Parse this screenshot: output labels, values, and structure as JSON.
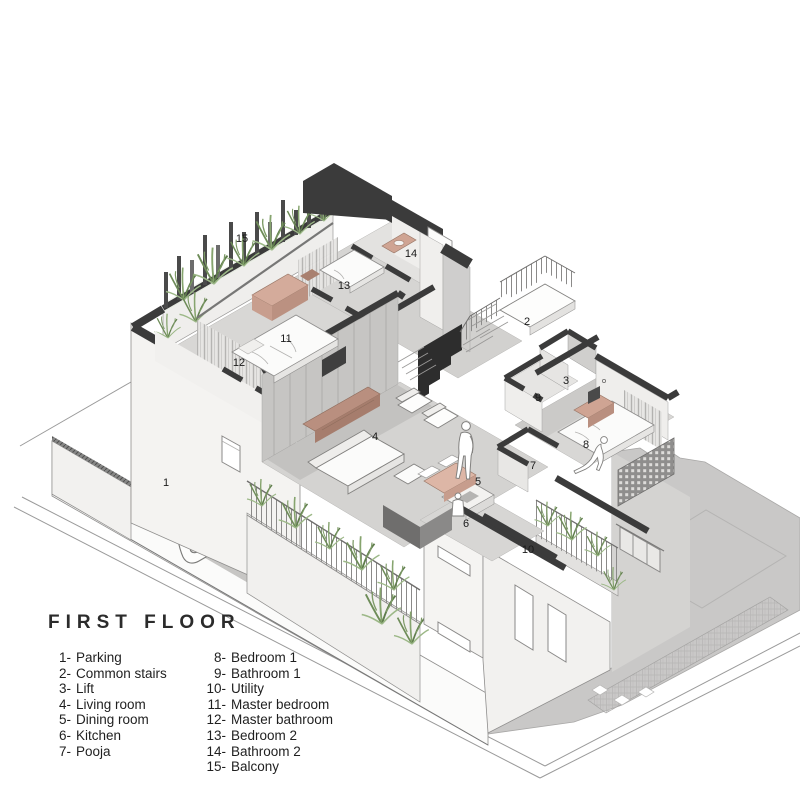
{
  "title": "FIRST FLOOR",
  "legend": {
    "column1": [
      {
        "num": "1-",
        "label": "Parking"
      },
      {
        "num": "2-",
        "label": "Common stairs"
      },
      {
        "num": "3-",
        "label": "Lift"
      },
      {
        "num": "4-",
        "label": "Living room"
      },
      {
        "num": "5-",
        "label": "Dining room"
      },
      {
        "num": "6-",
        "label": "Kitchen"
      },
      {
        "num": "7-",
        "label": "Pooja"
      }
    ],
    "column2": [
      {
        "num": "8-",
        "label": "Bedroom 1"
      },
      {
        "num": "9-",
        "label": "Bathroom 1"
      },
      {
        "num": "10-",
        "label": "Utility"
      },
      {
        "num": "11-",
        "label": "Master bedroom"
      },
      {
        "num": "12-",
        "label": "Master bathroom"
      },
      {
        "num": "13-",
        "label": "Bedroom 2"
      },
      {
        "num": "14-",
        "label": "Bathroom 2"
      },
      {
        "num": "15-",
        "label": "Balcony"
      }
    ]
  },
  "markers": [
    {
      "id": "parking",
      "num": "1",
      "x": 166,
      "y": 486
    },
    {
      "id": "common-stairs",
      "num": "2",
      "x": 527,
      "y": 325
    },
    {
      "id": "lift",
      "num": "3",
      "x": 566,
      "y": 384
    },
    {
      "id": "living-room",
      "num": "4",
      "x": 375,
      "y": 440
    },
    {
      "id": "dining-room",
      "num": "5",
      "x": 478,
      "y": 485
    },
    {
      "id": "kitchen",
      "num": "6",
      "x": 466,
      "y": 527
    },
    {
      "id": "pooja",
      "num": "7",
      "x": 533,
      "y": 469
    },
    {
      "id": "bedroom-1",
      "num": "8",
      "x": 586,
      "y": 448
    },
    {
      "id": "bathroom-1",
      "num": "9",
      "x": 538,
      "y": 401
    },
    {
      "id": "utility",
      "num": "10",
      "x": 528,
      "y": 553
    },
    {
      "id": "master-bedroom",
      "num": "11",
      "x": 286,
      "y": 342
    },
    {
      "id": "master-bathroom",
      "num": "12",
      "x": 239,
      "y": 366
    },
    {
      "id": "bedroom-2",
      "num": "13",
      "x": 344,
      "y": 289
    },
    {
      "id": "bathroom-2",
      "num": "14",
      "x": 411,
      "y": 257
    },
    {
      "id": "balcony",
      "num": "15",
      "x": 242,
      "y": 242
    }
  ],
  "palette": {
    "cut_wall": "#3b3b3b",
    "wall_light": "#e8e7e5",
    "wall_shadow": "#cbcac8",
    "floor": "#d6d5d3",
    "ground": "#c9c8c7",
    "wood": "#cfa493",
    "vegetation": "#7f9e6c"
  }
}
